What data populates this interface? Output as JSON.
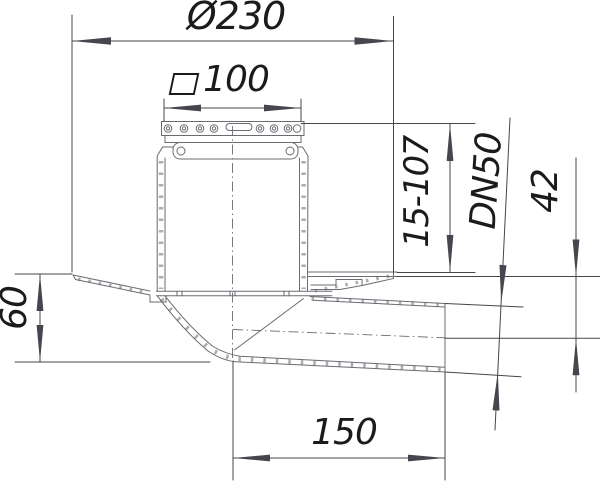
{
  "drawing": {
    "labels": {
      "diameter": "Ø230",
      "square_size": "100",
      "height_range": "15-107",
      "outlet_dn": "DN50",
      "outlet_axis_height": "42",
      "flange_depth": "60",
      "outlet_length": "150"
    },
    "colors": {
      "background": "#ffffff",
      "part_line": "#6b6b72",
      "dimension_line": "#45454c",
      "arrow_fill": "#46464e",
      "text": "#1b1b1b"
    }
  }
}
